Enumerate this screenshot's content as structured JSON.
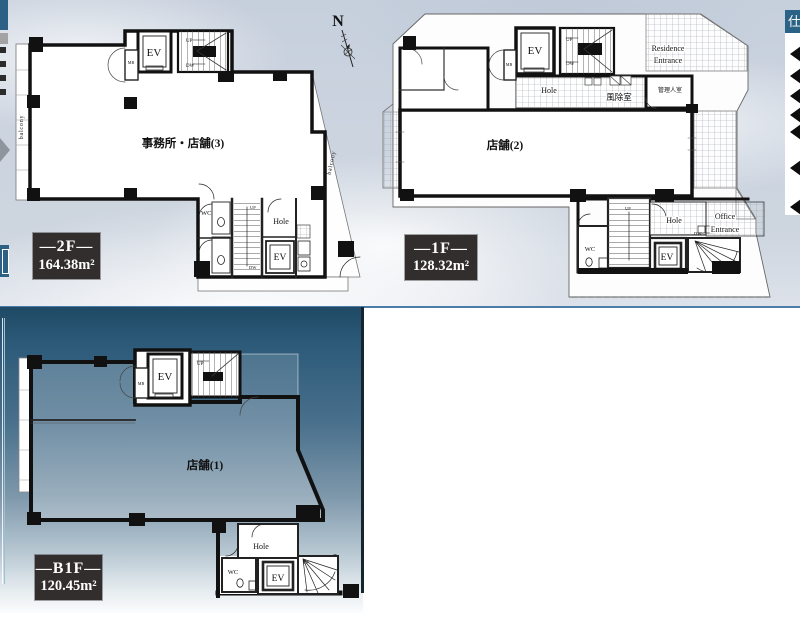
{
  "compass": {
    "north_label": "N"
  },
  "floors": {
    "f2": {
      "tag": "—2F—",
      "area_value": "164.38",
      "area_unit": "m²",
      "room_label": "事務所・店舗(3)",
      "ev": "EV",
      "mb": "MB",
      "up": "UP",
      "dw": "DW",
      "wc": "WC",
      "up_core": "UP",
      "dw_core": "DW",
      "hole": "Hole",
      "ev_core": "EV",
      "balcony_left": "balcony",
      "balcony_right": "balcony"
    },
    "f1": {
      "tag": "—1F—",
      "area_value": "128.32",
      "area_unit": "m²",
      "room_label": "店舗(2)",
      "ev": "EV",
      "mb": "MB",
      "up": "UP",
      "dw": "DW",
      "residence_line1": "Residence",
      "residence_line2": "Entrance",
      "hole_upper": "Hole",
      "windbreak_room": "風除室",
      "manager_room": "管理人室",
      "wc": "WC",
      "up_core": "UP",
      "hole_lower": "Hole",
      "ev_core": "EV",
      "dw_core": "DW",
      "office_line1": "Office",
      "office_line2": "Entrance"
    },
    "b1": {
      "tag": "—B1F—",
      "area_value": "120.45",
      "area_unit": "m²",
      "room_label": "店舗(1)",
      "ev": "EV",
      "mb": "MB",
      "up": "UP",
      "hole": "Hole",
      "wc": "WC",
      "ev_core": "EV",
      "up_core": "UP"
    }
  },
  "side_panel": {
    "header_text": "仕",
    "bullet_count": 7
  },
  "colors": {
    "accent_blue": "#2c6185",
    "panel_top": "#1f4964",
    "rule_blue": "#4b7da8",
    "tag_box": "#332e2e"
  }
}
